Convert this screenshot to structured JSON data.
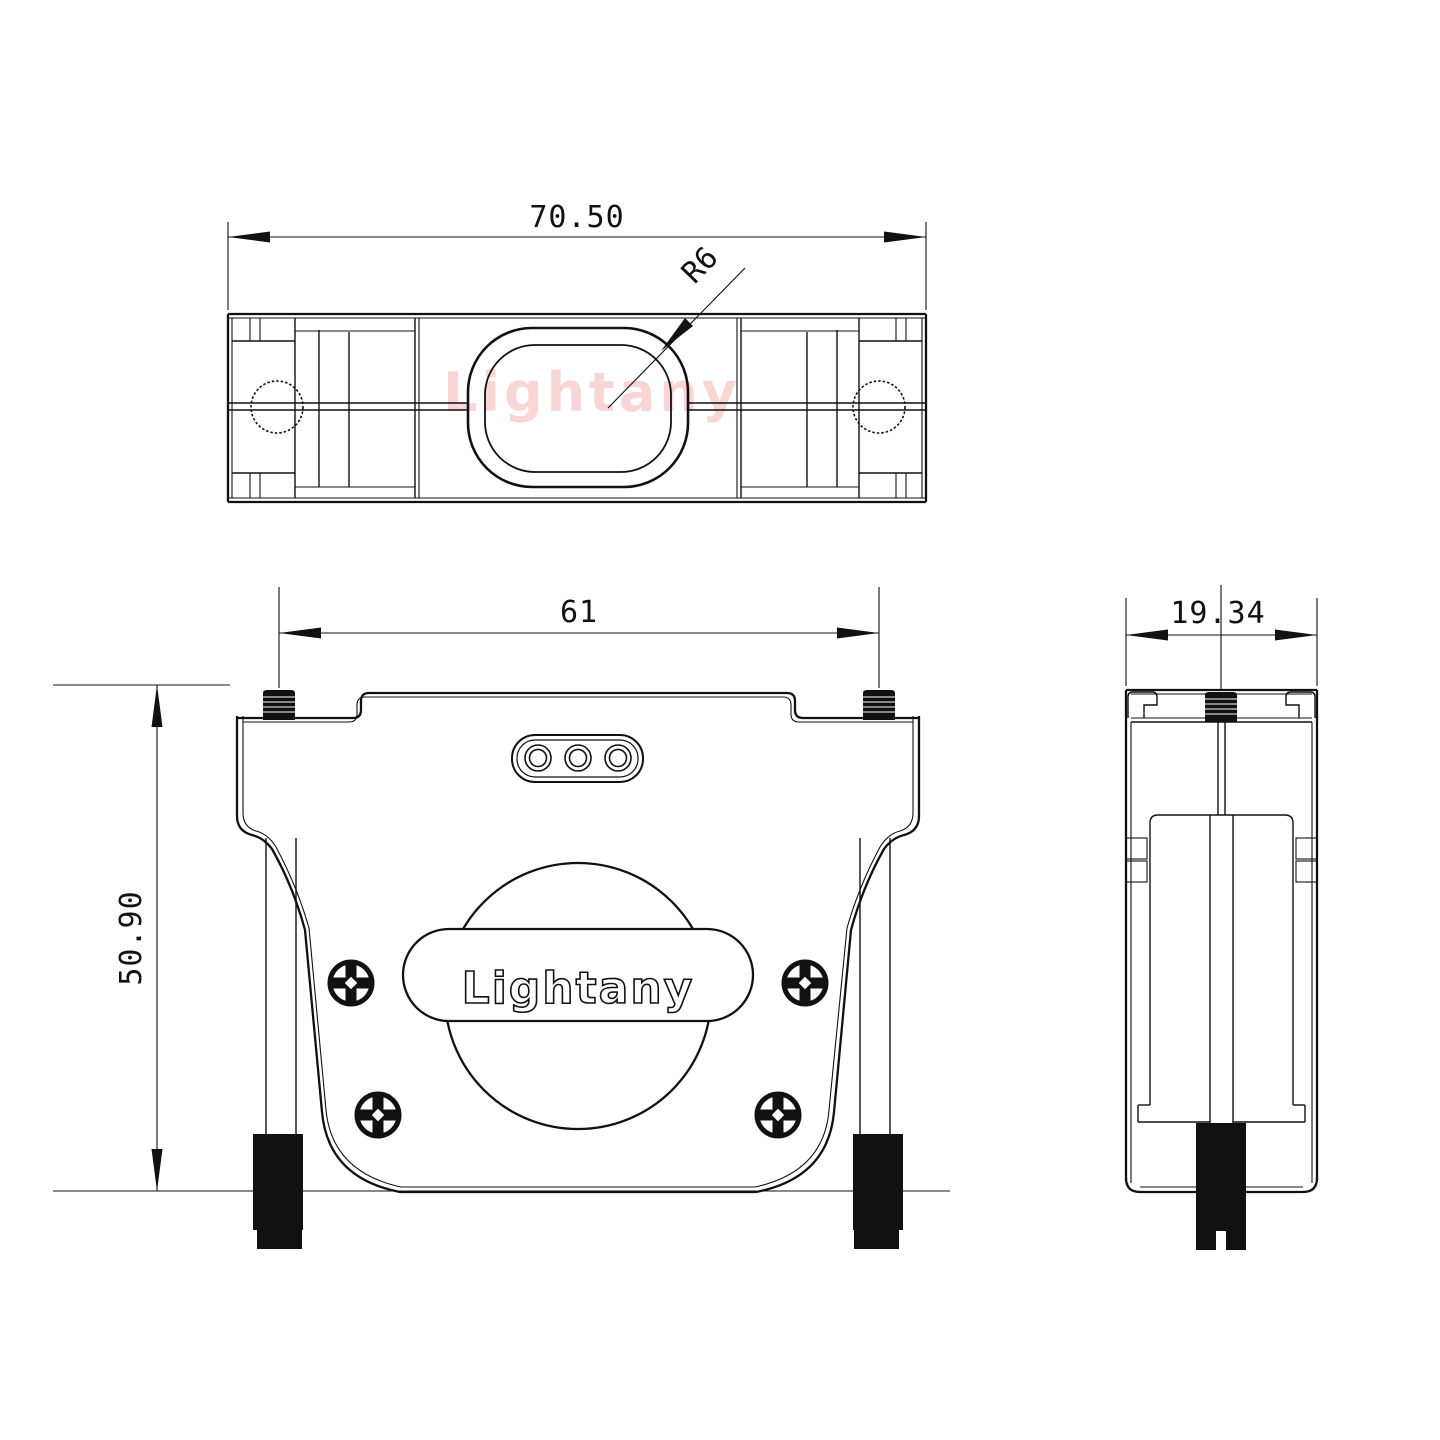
{
  "branding": {
    "watermark": "Lightany",
    "logo": "Lightany"
  },
  "dimensions": {
    "top_width": "70.50",
    "radius_callout": "R6",
    "front_width": "61",
    "front_height": "50.90",
    "side_width": "19.34"
  },
  "colors": {
    "line": "#111111",
    "watermark": "#f8d6d6",
    "background": "#ffffff"
  }
}
